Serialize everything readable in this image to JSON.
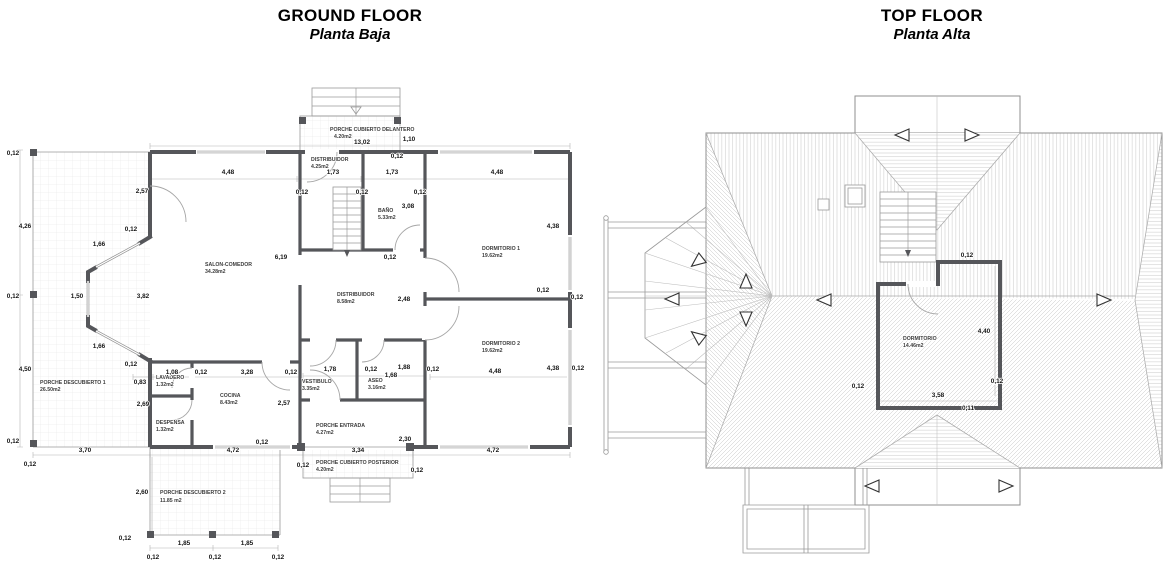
{
  "colors": {
    "wall": "#55565a",
    "thin_line": "#9a9a9a",
    "hatch": "#c6c6c6",
    "dim_text": "#161616",
    "background": "#ffffff"
  },
  "ground_floor": {
    "title": "GROUND FLOOR",
    "subtitle": "Planta Baja",
    "rooms": {
      "porche_delantero": {
        "name": "PORCHE CUBIERTO DELANTERO",
        "area": "4.20m2"
      },
      "distribuidor_top": {
        "name": "DISTRIBUIDOR",
        "area": "4.25m2"
      },
      "bano": {
        "name": "BAÑO",
        "area": "5.33m2"
      },
      "salon": {
        "name": "SALON-COMEDOR",
        "area": "34.28m2"
      },
      "distribuidor": {
        "name": "DISTRIBUIDOR",
        "area": "8.58m2"
      },
      "dormitorio1": {
        "name": "DORMITORIO 1",
        "area": "19.62m2"
      },
      "dormitorio2": {
        "name": "DORMITORIO 2",
        "area": "19.62m2"
      },
      "lavadero": {
        "name": "LAVADERO",
        "area": "1.32m2"
      },
      "cocina": {
        "name": "COCINA",
        "area": "8.43m2"
      },
      "despensa": {
        "name": "DESPENSA",
        "area": "1.32m2"
      },
      "vestibulo": {
        "name": "VESTIBULO",
        "area": "3.35m2"
      },
      "aseo": {
        "name": "ASEO",
        "area": "3.16m2"
      },
      "porche_entrada": {
        "name": "PORCHE ENTRADA",
        "area": "4.27m2"
      },
      "porche_descubierto1": {
        "name": "PORCHE DESCUBIERTO 1",
        "area": "26.50m2"
      },
      "porche_posterior": {
        "name": "PORCHE CUBIERTO POSTERIOR",
        "area": "4.20m2"
      },
      "porche_descubierto2": {
        "name": "PORCHE DESCUBIERTO 2",
        "area": "11.85 m2"
      }
    }
  },
  "top_floor": {
    "title": "TOP FLOOR",
    "subtitle": "Planta Alta",
    "rooms": {
      "dormitorio": {
        "name": "DORMITORIO",
        "area": "14.46m2"
      }
    }
  },
  "dims": {
    "v012": "0,12",
    "v011": "0,11",
    "v083": "0,83",
    "v108": "1,08",
    "v110": "1,10",
    "v150": "1,50",
    "v166": "1,66",
    "v168": "1,68",
    "v173": "1,73",
    "v178": "1,78",
    "v185": "1,85",
    "v188": "1,88",
    "v230": "2,30",
    "v248": "2,48",
    "v257": "2,57",
    "v260": "2,60",
    "v269": "2,69",
    "v308": "3,08",
    "v328": "3,28",
    "v334": "3,34",
    "v358": "3,58",
    "v370": "3,70",
    "v382": "3,82",
    "v426": "4,26",
    "v438": "4,38",
    "v440": "4,40",
    "v448": "4,48",
    "v450": "4,50",
    "v472": "4,72",
    "v619": "6,19",
    "v1302": "13,02"
  }
}
